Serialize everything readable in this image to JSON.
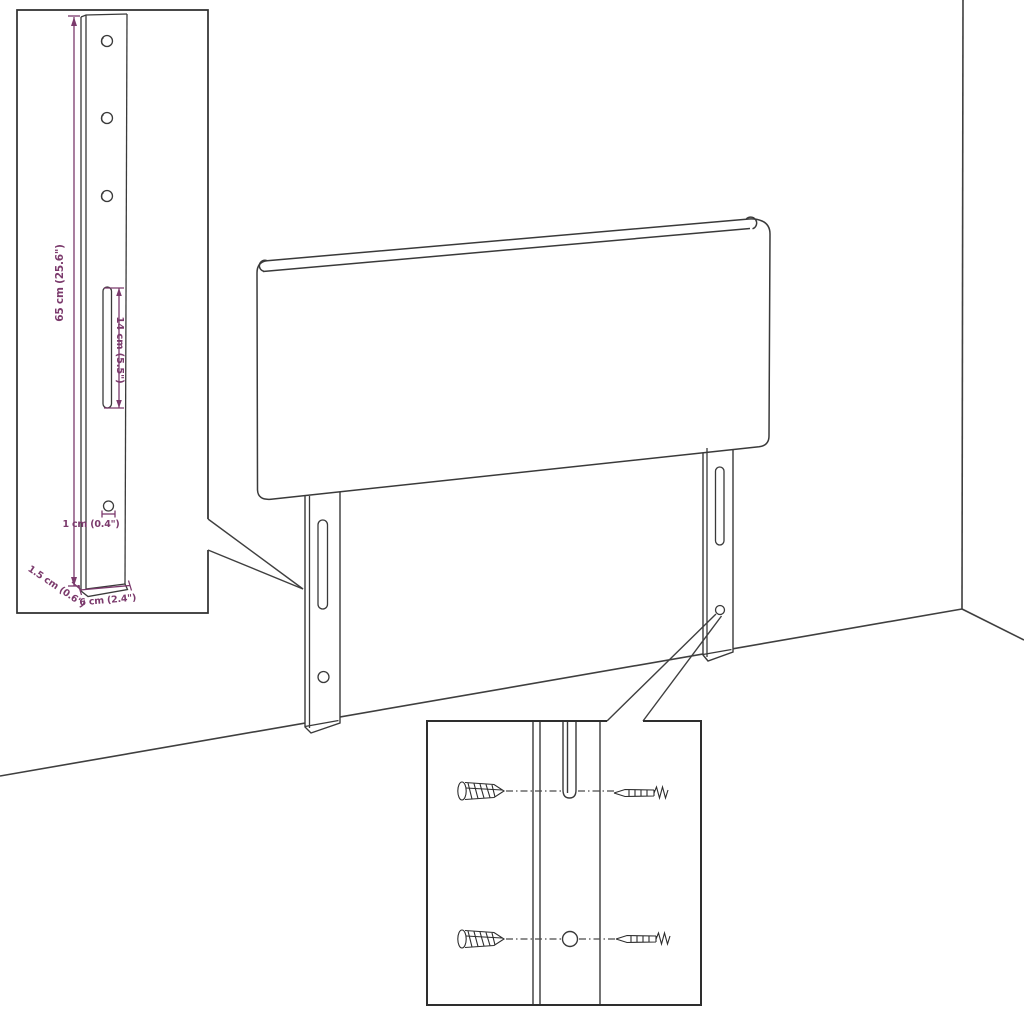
{
  "diagram": {
    "kind": "headboard-assembly-diagram",
    "colors": {
      "ink": "#3a3a3a",
      "dimension": "#7b3a6c",
      "background": "#ffffff"
    },
    "leg_detail_inset": {
      "labels": {
        "total_height": "65 cm (25.6\")",
        "slot_length": "14 cm (5.5\")",
        "hole_diameter": "1 cm (0.4\")",
        "thickness": "1.5 cm (0.6\")",
        "width": "6 cm (2.4\")"
      }
    },
    "icons": {
      "wood_screw": "wood-screw-icon",
      "machine_screw": "machine-screw-icon"
    }
  }
}
